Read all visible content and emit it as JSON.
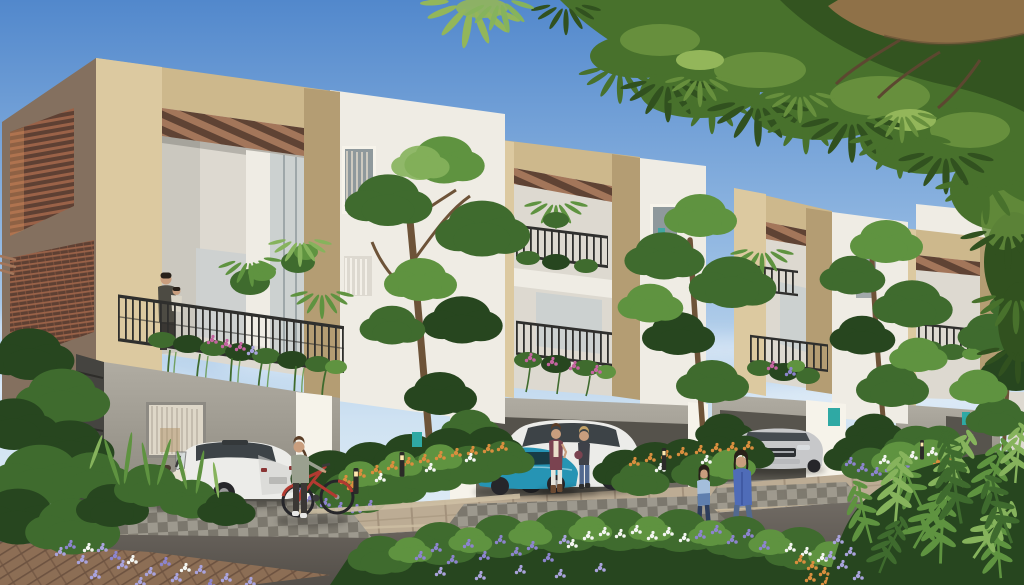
{
  "image": {
    "type": "photorealistic architectural rendering",
    "aria_label": "Daytime rendering of a row of four modern three-storey townhouses with sand-stone frames, white walls, planted balconies, ground-floor parking bays with cars, residents on balconies and street, landscaped flower beds, a road in the foreground and a leafy tree canopy overhanging from the top right"
  },
  "scene": {
    "time_of_day": "daytime, sunny, clear blue sky with thin clouds",
    "buildings": [
      {
        "id": "townhouse-1",
        "position": "left, closest",
        "features": [
          "rooftop pergola with timber slats",
          "terracotta louvered screens on side wall",
          "second-floor balcony with black railing, palms and pink flower boxes",
          "man holding child on balcony",
          "grey ground floor with window",
          "stacked-slate pillar",
          "driveway parking"
        ]
      },
      {
        "id": "townhouse-2",
        "position": "center",
        "features": [
          "beige frame",
          "two stacked balconies with plants and pink flowers",
          "white side wing with window",
          "ground-floor parking bay"
        ]
      },
      {
        "id": "townhouse-3",
        "position": "center-right",
        "features": [
          "beige frame",
          "planted balconies",
          "teal address plaque",
          "ground-floor parking bay"
        ]
      },
      {
        "id": "townhouse-4",
        "position": "far right, smallest",
        "features": [
          "beige frame",
          "planted balcony",
          "ground-floor parking bay"
        ]
      }
    ],
    "vehicles": [
      {
        "id": "white-sedan",
        "color": "white",
        "location": "driveway-1, seen from rear"
      },
      {
        "id": "cream-scooter",
        "color": "cream/black",
        "location": "driveway-1, left of sedan"
      },
      {
        "id": "teal-coupe",
        "color": "teal",
        "location": "driveway-2, partly behind shrubs"
      },
      {
        "id": "white-suv",
        "color": "white",
        "location": "driveway-2, behind teal coupe"
      },
      {
        "id": "silver-sedan",
        "color": "silver",
        "location": "driveway-3, facing street"
      }
    ],
    "people": [
      {
        "id": "man-holding-child",
        "location": "townhouse-1 second-floor balcony"
      },
      {
        "id": "woman-with-bicycle",
        "detail": "grey top, dark leggings, pushing red step-through bicycle",
        "location": "in front of driveway-1"
      },
      {
        "id": "woman-maroon-cardigan",
        "detail": "cream scarf, white trousers, brown boots, phone to ear",
        "location": "driveway-2"
      },
      {
        "id": "woman-blue-jeans",
        "detail": "dark top, shoulder bag",
        "location": "driveway-2"
      },
      {
        "id": "woman-blue-coat",
        "detail": "long cornflower-blue coat, jeans",
        "location": "walking on street, right"
      },
      {
        "id": "girl-blue-sweater",
        "detail": "ombre blue sweater, navy trousers",
        "location": "walking beside woman in blue coat"
      }
    ],
    "vegetation": [
      {
        "id": "overhanging-canopy",
        "detail": "large tree with drooping leaflets and thick branch entering from top right"
      },
      {
        "id": "street-trees",
        "count": 4,
        "detail": "slender trees between and in front of townhouses"
      },
      {
        "id": "balcony-planting",
        "detail": "palms, trailing vines, pink bougainvillea flower boxes"
      },
      {
        "id": "flower-beds",
        "detail": "orange, purple, lavender and white flowers with shrubs between driveways and along road"
      },
      {
        "id": "fern-mound",
        "detail": "dense ferns in bottom-right corner"
      }
    ],
    "street": {
      "road": "dark asphalt curving across foreground",
      "sidewalk": "tan paver band along house fronts",
      "driveways": "chequered grey paver aprons",
      "pavers_bottom_left": "reddish-brown diagonal pavers",
      "lighting": "small black bollard path lights"
    }
  },
  "colors": {
    "sky_top": "#5288cc",
    "sky_mid": "#93b9e2",
    "sky_low": "#cfe2f2",
    "sky_horizon": "#e9f2f8",
    "cloud": "#f6fafd",
    "canopy_dark": "#31511f",
    "canopy_mid": "#48712c",
    "canopy_light": "#678f3d",
    "canopy_hi": "#93b65a",
    "branch": "#8f7148",
    "branch_dark": "#5c4730",
    "trunk": "#6d5338",
    "stone_light": "#dcc9a0",
    "stone_mid": "#cdb88c",
    "stone_dark": "#b49d73",
    "side_wall": "#84705f",
    "louver": "#9a6248",
    "louver_dark": "#5e4033",
    "louver_sun": "#c98a58",
    "pergola": "#a3765a",
    "pergola_gap": "#5f4334",
    "wall_white": "#efece4",
    "wall_white_shade": "#ddd9d0",
    "wall_bright": "#f6f3ea",
    "wall_grey": "#b0aca2",
    "wall_grey_dark": "#8b877d",
    "garage_shadow": "#6e6a61",
    "garage_dark": "#57544d",
    "slate": "#454440",
    "slate_dark": "#2e2d2a",
    "railing": "#2f2f2d",
    "glass": "#ccd1d0",
    "glass_dark": "#8f999c",
    "curtain": "#ded7c8",
    "plant_dark": "#27461f",
    "plant_mid": "#3f6b2e",
    "plant_light": "#5f9340",
    "plant_pale": "#86b35c",
    "flower_pink": "#c464a0",
    "flower_purple": "#8c84cd",
    "flower_lav": "#a9a3dc",
    "flower_white": "#f3f5f1",
    "flower_orange": "#d98e3e",
    "road": "#756f68",
    "road_dark": "#544f49",
    "sidewalk": "#bcac94",
    "sidewalk_dark": "#a3927c",
    "curb": "#cdbfa3",
    "paver_brown": "#8f6f55",
    "paver_brown_dark": "#6e5340",
    "driveway": "#9d998e",
    "driveway_dark": "#7b776d",
    "car_white": "#ecece9",
    "car_white_shade": "#d2d2cf",
    "glasshouse": "#3d4347",
    "car_teal": "#2694b4",
    "car_silver": "#c7c8ca",
    "tire": "#26262a",
    "hub": "#9a9a9a",
    "bike_red": "#b23a31",
    "skin": "#c99e7e",
    "hair_dark": "#272019",
    "hair_brown": "#5b3e28",
    "hair_blonde": "#c2a166",
    "coat_blue": "#4f6cb8",
    "jeans": "#52698f",
    "sweater_blue": "#a4bedb",
    "sweater_blue_dark": "#5f7fae",
    "navy": "#2c3d5c",
    "maroon": "#7a4350",
    "cream": "#e9dfca",
    "grey_top": "#9aa08f",
    "pants_dark": "#3a3734",
    "white_pants": "#e6e4dc",
    "dark_top": "#3e4148",
    "teal_plaque": "#2fa9a4",
    "bollard": "#2b2a28",
    "bollard_light": "#ffe9b0"
  }
}
